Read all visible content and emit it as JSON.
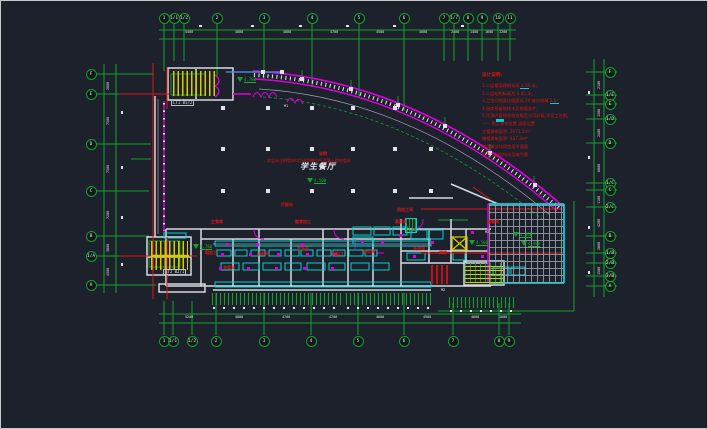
{
  "canvas": {
    "width": 706,
    "height": 427,
    "background": "#1c212c"
  },
  "palette": {
    "grid_green": "#14a12c",
    "wall_white": "#d6d9dd",
    "magenta": "#dd00dd",
    "cyan": "#00d2d2",
    "red": "#e01414",
    "yellow": "#d6ca00",
    "blue": "#4f7fd9",
    "gray": "#98a0ac",
    "text_white": "#dfe3e8"
  },
  "room": {
    "title": "学生餐厅",
    "elevation": "4.500"
  },
  "center_note": {
    "line1": "说明",
    "line2": "本层未注明墙体均为200厚加气混凝土砌块墙体"
  },
  "grid_bubbles": {
    "top": [
      {
        "label": "1",
        "x": 163
      },
      {
        "label": "1/1",
        "x": 173
      },
      {
        "label": "1/2",
        "x": 183
      },
      {
        "label": "2",
        "x": 216
      },
      {
        "label": "3",
        "x": 263
      },
      {
        "label": "4",
        "x": 311
      },
      {
        "label": "5",
        "x": 358
      },
      {
        "label": "6",
        "x": 403
      },
      {
        "label": "7",
        "x": 443
      },
      {
        "label": "1/7",
        "x": 453
      },
      {
        "label": "8",
        "x": 467
      },
      {
        "label": "9",
        "x": 481
      },
      {
        "label": "10",
        "x": 497
      },
      {
        "label": "11",
        "x": 509
      }
    ],
    "bottom": [
      {
        "label": "1",
        "x": 163
      },
      {
        "label": "1/1",
        "x": 172
      },
      {
        "label": "1/2",
        "x": 191
      },
      {
        "label": "2",
        "x": 215
      },
      {
        "label": "3",
        "x": 263
      },
      {
        "label": "4",
        "x": 310
      },
      {
        "label": "5",
        "x": 357
      },
      {
        "label": "6",
        "x": 403
      },
      {
        "label": "7",
        "x": 452
      },
      {
        "label": "8",
        "x": 498
      },
      {
        "label": "9",
        "x": 508
      }
    ],
    "left": [
      {
        "label": "F",
        "y": 73
      },
      {
        "label": "E",
        "y": 93
      },
      {
        "label": "D",
        "y": 143
      },
      {
        "label": "C",
        "y": 190
      },
      {
        "label": "B",
        "y": 235
      },
      {
        "label": "1/A",
        "y": 255
      },
      {
        "label": "A",
        "y": 284
      }
    ],
    "right": [
      {
        "label": "F",
        "y": 71
      },
      {
        "label": "1/E",
        "y": 94
      },
      {
        "label": "E",
        "y": 103
      },
      {
        "label": "1/D",
        "y": 118
      },
      {
        "label": "D",
        "y": 142
      },
      {
        "label": "1/C",
        "y": 182
      },
      {
        "label": "C",
        "y": 189
      },
      {
        "label": "2/C",
        "y": 206
      },
      {
        "label": "B",
        "y": 235
      },
      {
        "label": "1/B",
        "y": 252
      },
      {
        "label": "2/B",
        "y": 262
      },
      {
        "label": "3/B",
        "y": 275
      },
      {
        "label": "A",
        "y": 285
      }
    ]
  },
  "notes": {
    "x": 481,
    "title": {
      "y": 73,
      "text": "设计说明:"
    },
    "lines": [
      {
        "y": 83,
        "text": "1.二层楼面建筑标高 4.50 米,"
      },
      {
        "y": 91,
        "text": "2.二层结构标高为 4.45 米,"
      },
      {
        "y": 98,
        "text": "3.卫生间地面比楼面低 20 坡向地漏 1.0,"
      },
      {
        "y": 106,
        "text": "4.厨房预留给排水及排烟条件,"
      },
      {
        "y": 113,
        "text": "5.吊顶内管线验收合格后方可封板,详见工艺图,"
      },
      {
        "y": 121,
        "text": "—— 防火卷帘位置      剖面位置"
      },
      {
        "y": 129,
        "text": "主楼建筑面积: 2071.1m²"
      },
      {
        "y": 136,
        "text": "辅楼建筑面积: 437.3m²"
      },
      {
        "y": 144,
        "text": "其余做法均同首层平面图"
      },
      {
        "y": 152,
        "text": "详见二层给排水及电气图."
      }
    ]
  },
  "kitchen_labels": [
    {
      "x": 210,
      "y": 219,
      "text": "主食库"
    },
    {
      "x": 294,
      "y": 219,
      "text": "副食加工"
    },
    {
      "x": 396,
      "y": 207,
      "text": "热加工间"
    },
    {
      "x": 394,
      "y": 219,
      "text": "蒸饭间"
    },
    {
      "x": 486,
      "y": 219,
      "text": "备餐间"
    },
    {
      "x": 204,
      "y": 250,
      "text": "粗加工"
    },
    {
      "x": 222,
      "y": 265,
      "text": "洗菜间"
    },
    {
      "x": 256,
      "y": 251,
      "text": "切配间"
    },
    {
      "x": 296,
      "y": 246,
      "text": "烹饪间"
    },
    {
      "x": 330,
      "y": 251,
      "text": "售饭口"
    },
    {
      "x": 362,
      "y": 249,
      "text": "面点间"
    },
    {
      "x": 412,
      "y": 246,
      "text": "洗消间"
    },
    {
      "x": 280,
      "y": 202,
      "text": "打饭台"
    },
    {
      "x": 438,
      "y": 250,
      "text": "库房"
    }
  ],
  "stair_tags": [
    {
      "x": 170,
      "y": 99,
      "text": "LT1 B1/2"
    },
    {
      "x": 162,
      "y": 268,
      "text": "LT2 B2/1"
    }
  ],
  "door_tags": [
    {
      "x": 484,
      "y": 230,
      "text": "M2"
    },
    {
      "x": 440,
      "y": 288,
      "text": "M2"
    },
    {
      "x": 283,
      "y": 104,
      "text": "M1"
    }
  ],
  "elevations": [
    {
      "x": 236,
      "y": 76,
      "value": "4.780"
    },
    {
      "x": 306,
      "y": 177,
      "value": "4.500"
    },
    {
      "x": 468,
      "y": 239,
      "value": "4.500"
    },
    {
      "x": 512,
      "y": 231,
      "value": "4.480"
    },
    {
      "x": 520,
      "y": 240,
      "value": "4.480"
    },
    {
      "x": 192,
      "y": 243,
      "value": "4.780"
    }
  ],
  "dimensions": {
    "top": [
      {
        "x": 189,
        "text": "5400"
      },
      {
        "x": 239,
        "text": "4800"
      },
      {
        "x": 287,
        "text": "4800"
      },
      {
        "x": 334,
        "text": "4700"
      },
      {
        "x": 380,
        "text": "4500"
      },
      {
        "x": 423,
        "text": "4000"
      },
      {
        "x": 455,
        "text": "2400"
      },
      {
        "x": 474,
        "text": "1400"
      },
      {
        "x": 489,
        "text": "1600"
      },
      {
        "x": 503,
        "text": "1200"
      }
    ],
    "bottom": [
      {
        "x": 189,
        "text": "5200"
      },
      {
        "x": 239,
        "text": "4800"
      },
      {
        "x": 286,
        "text": "4700"
      },
      {
        "x": 333,
        "text": "4700"
      },
      {
        "x": 380,
        "text": "4600"
      },
      {
        "x": 427,
        "text": "4900"
      },
      {
        "x": 475,
        "text": "4600"
      },
      {
        "x": 503,
        "text": "1000"
      }
    ],
    "left": [
      {
        "y": 83,
        "text": "2000"
      },
      {
        "y": 118,
        "text": "7500"
      },
      {
        "y": 166,
        "text": "7500"
      },
      {
        "y": 212,
        "text": "7200"
      },
      {
        "y": 245,
        "text": "3000"
      },
      {
        "y": 269,
        "text": "4500"
      }
    ],
    "right": [
      {
        "y": 82,
        "text": "2100"
      },
      {
        "y": 110,
        "text": "1500"
      },
      {
        "y": 130,
        "text": "2400"
      },
      {
        "y": 165,
        "text": "6000"
      },
      {
        "y": 197,
        "text": "1100"
      },
      {
        "y": 220,
        "text": "4200"
      },
      {
        "y": 243,
        "text": "2600"
      },
      {
        "y": 268,
        "text": "1500"
      }
    ]
  }
}
